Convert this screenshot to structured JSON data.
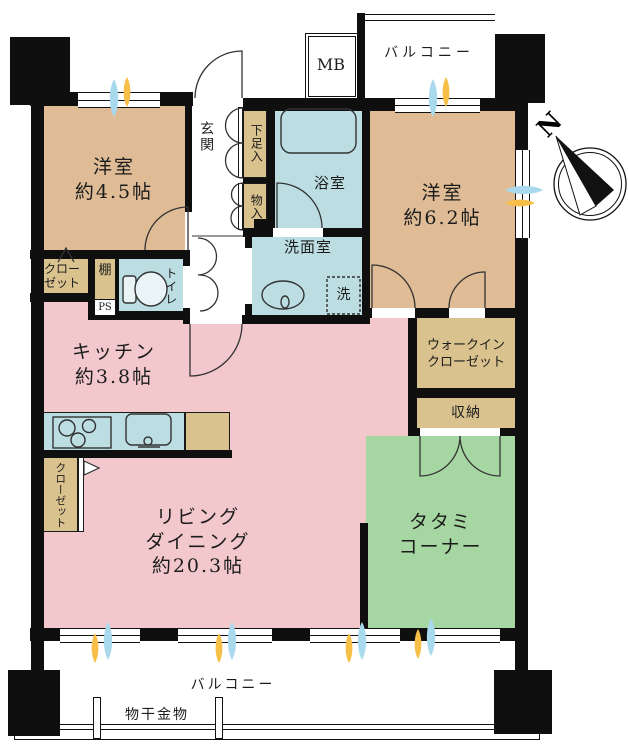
{
  "compass": {
    "north": "N"
  },
  "labels": {
    "balcony_top": "バルコニー",
    "mb": "MB",
    "entrance": "玄関",
    "shoe_cabinet": "下足入",
    "hall_storage": "物入",
    "bathroom": "浴室",
    "washroom": "洗面室",
    "washer": "洗",
    "toilet": "トイレ",
    "shelf": "棚",
    "pipe_space": "PS",
    "storage": "収納",
    "balcony_bottom": "バルコニー",
    "laundry_hardware": "物干金物"
  },
  "rooms": {
    "bedroom_west": {
      "name": "洋室",
      "area": "約4.5帖"
    },
    "bedroom_east": {
      "name": "洋室",
      "area": "約6.2帖"
    },
    "kitchen": {
      "name": "キッチン",
      "area": "約3.8帖"
    },
    "living_dining": {
      "line1": "リビング",
      "line2": "ダイニング",
      "area": "約20.3帖"
    },
    "tatami": {
      "line1": "タタミ",
      "line2": "コーナー"
    },
    "walk_in_closet": {
      "line1": "ウォークイン",
      "line2": "クローゼット"
    },
    "closet_west": {
      "line1": "クロー",
      "line2": "ゼット"
    },
    "closet_kitchen": {
      "line1": "クロー",
      "line2": "ゼット"
    }
  },
  "colors": {
    "bedroom": "#dfbc96",
    "storage": "#d9c28e",
    "living": "#f2c8cc",
    "wet_area": "#bcdee2",
    "tatami": "#a6d6a1",
    "window_light": "#f7bf47",
    "window_air": "#a9d9ec",
    "wall": "#0f0f0f"
  }
}
